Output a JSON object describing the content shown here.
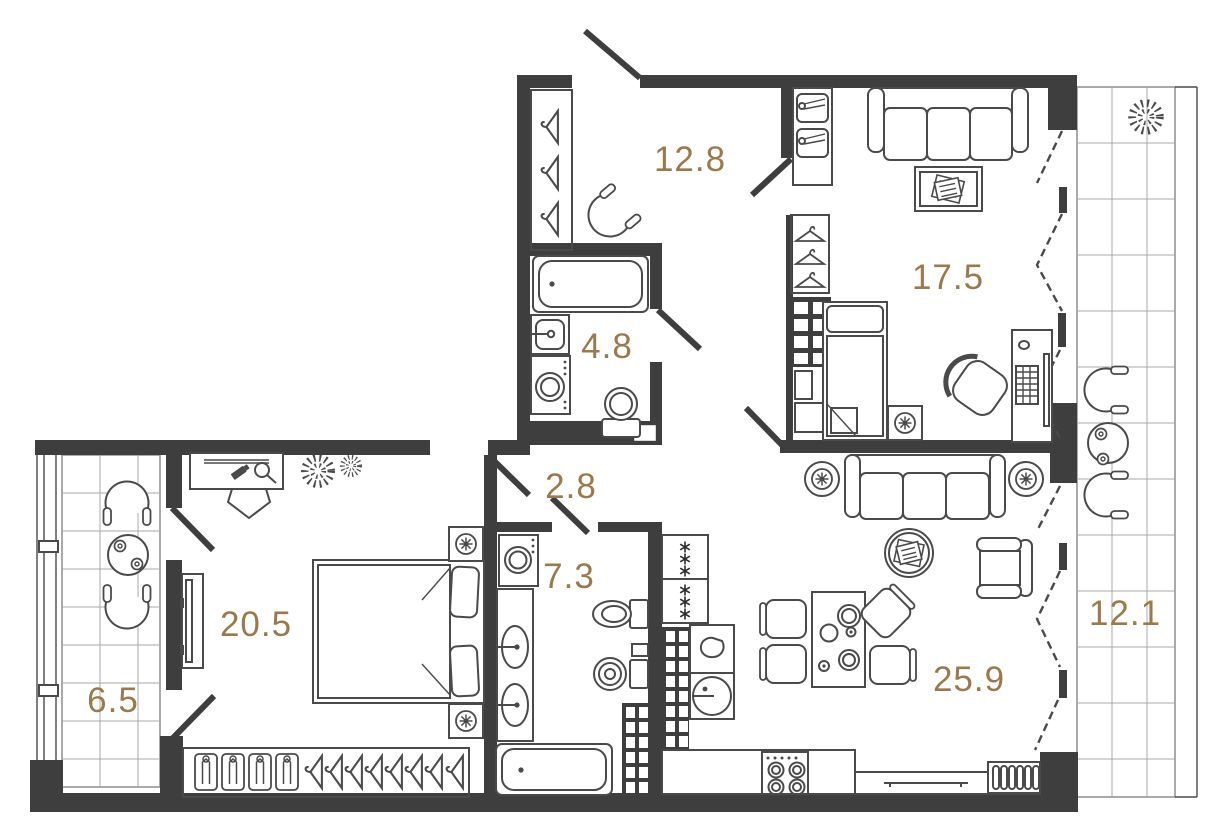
{
  "plan": {
    "type": "apartment-floor-plan",
    "accent_color": "#9a7a4b",
    "wall_color": "#3e3e3e",
    "furniture_color": "#4a4a4a",
    "rooms": [
      {
        "id": "hallway",
        "area": "12.8",
        "furniture": [
          "wardrobe-hangers",
          "armchair",
          "shoe-cabinet",
          "entrance-door"
        ]
      },
      {
        "id": "bedroom-upper",
        "area": "17.5",
        "furniture": [
          "sofa",
          "coffee-table-magazines",
          "wardrobe-hangers",
          "ventilation-shaft",
          "single-bed",
          "bedside-table-plant",
          "desk-computer",
          "office-chair"
        ]
      },
      {
        "id": "bathroom-upper",
        "area": "4.8",
        "furniture": [
          "bathtub",
          "sink",
          "washing-machine",
          "toilet",
          "duct-box"
        ]
      },
      {
        "id": "corridor",
        "area": "2.8",
        "furniture": [
          "door-swings"
        ]
      },
      {
        "id": "bathroom-lower",
        "area": "7.3",
        "furniture": [
          "washing-machine",
          "double-sink-vanity",
          "toilet",
          "bidet",
          "bathtub",
          "shaft-shelving"
        ]
      },
      {
        "id": "bedroom-main",
        "area": "20.5",
        "furniture": [
          "dressing-table",
          "stool",
          "plants",
          "tv-panel",
          "double-bed",
          "nightstand-plants",
          "wardrobe-shelves-hangers"
        ]
      },
      {
        "id": "balcony-left",
        "area": "6.5",
        "furniture": [
          "tub-chairs",
          "round-table-cups",
          "tiled-floor",
          "glazing"
        ]
      },
      {
        "id": "kitchen-living",
        "area": "25.9",
        "furniture": [
          "fridge-freezer",
          "kettle-unit",
          "round-sink",
          "stove-4-burners",
          "counter",
          "towel-bar",
          "dish-rack",
          "dining-table-plates",
          "dining-chairs",
          "sofa",
          "side-table-plants",
          "coffee-table-magazines",
          "armchair"
        ]
      },
      {
        "id": "balcony-right",
        "area": "12.1",
        "furniture": [
          "plant",
          "tub-chairs",
          "round-table-cups",
          "tiled-floor",
          "glazing"
        ]
      }
    ]
  }
}
